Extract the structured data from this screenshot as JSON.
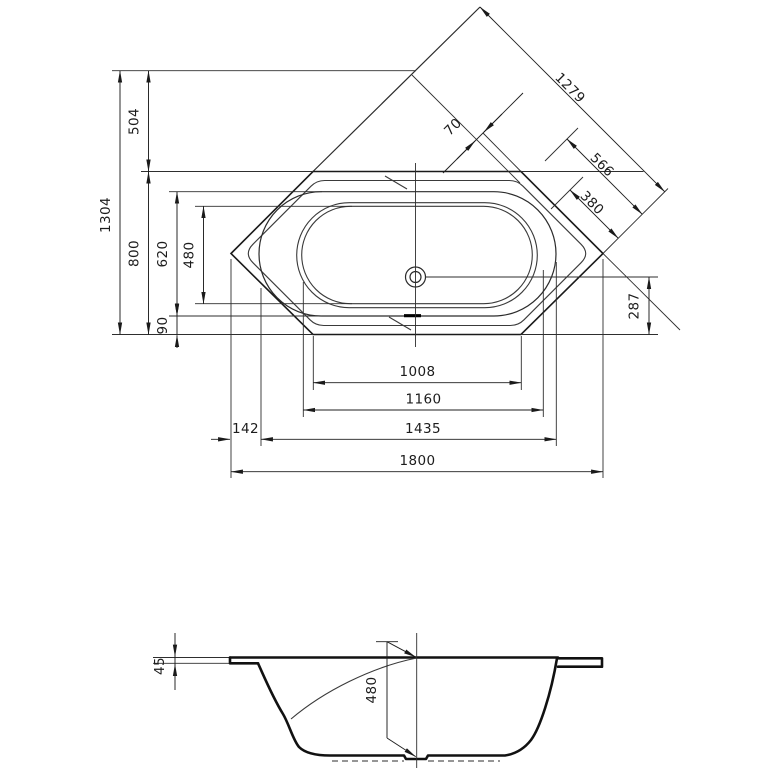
{
  "drawing": {
    "background": "#ffffff",
    "line_color": "#1a1a1a",
    "plan": {
      "dims": {
        "d1304": "1304",
        "d504": "504",
        "d800": "800",
        "d620": "620",
        "d480": "480",
        "d90": "90",
        "d287": "287",
        "d1008": "1008",
        "d1160": "1160",
        "d1435": "1435",
        "d142": "142",
        "d1800": "1800",
        "d1279": "1279",
        "d70": "70",
        "d566": "566",
        "d380": "380"
      }
    },
    "section": {
      "dims": {
        "d45": "45",
        "d480": "480"
      }
    }
  }
}
